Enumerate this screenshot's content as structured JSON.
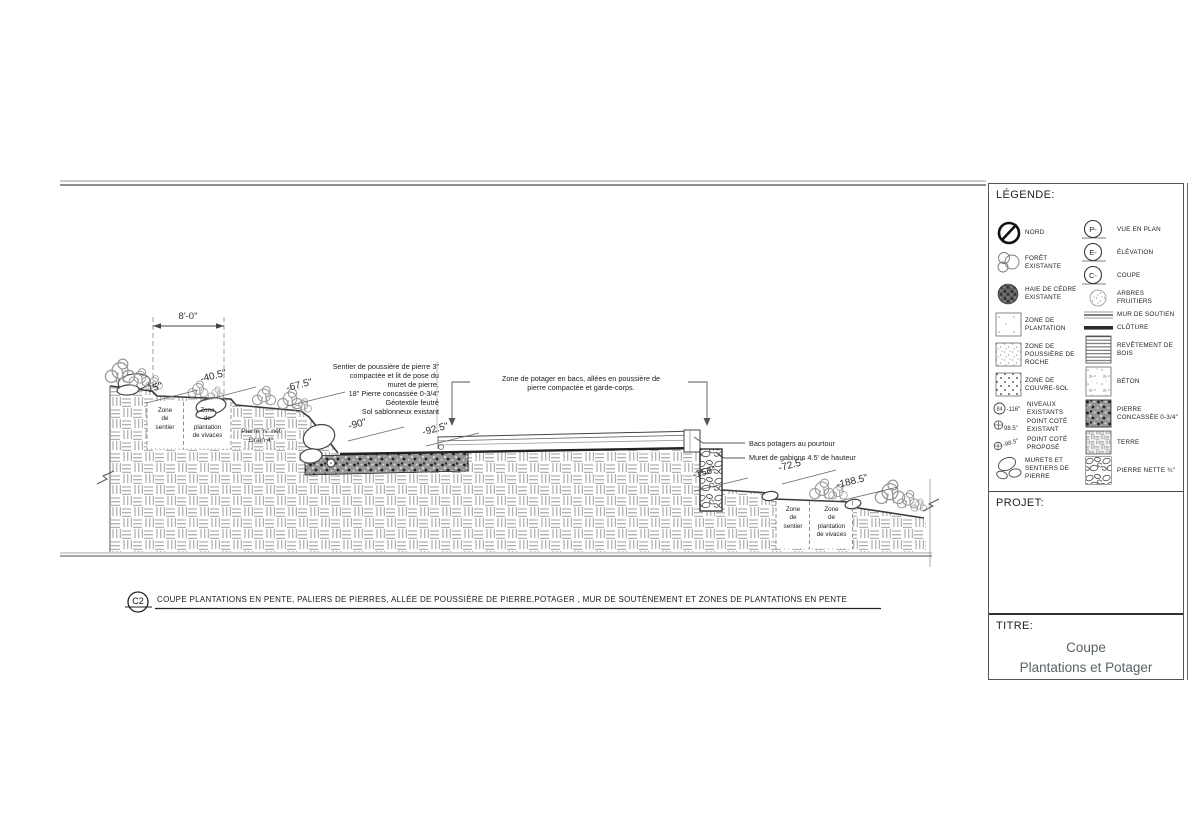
{
  "legend": {
    "title": "LÉGENDE:",
    "col1": [
      {
        "icon": "north-icon",
        "label": "NORD"
      },
      {
        "icon": "existing-forest-icon",
        "label": "FORÊT EXISTANTE"
      },
      {
        "icon": "cedar-hedge-icon",
        "label": "HAIE DE CÈDRE EXISTANTE"
      },
      {
        "icon": "planting-zone-swatch",
        "label": "ZONE DE PLANTATION"
      },
      {
        "icon": "rock-dust-zone-swatch",
        "label": "ZONE DE POUSSIÈRE DE ROCHE"
      },
      {
        "icon": "groundcover-zone-swatch",
        "label": "ZONE DE COUVRE-SOL"
      },
      {
        "icon": "existing-levels-icon",
        "symbol": "84",
        "value": "-116\"",
        "label": "NIVEAUX EXISTANTS"
      },
      {
        "icon": "existing-spot-elevation-icon",
        "value": "98.5\"",
        "label": "POINT COTÉ EXISTANT"
      },
      {
        "icon": "proposed-spot-elevation-icon",
        "value": "-98.5\"",
        "label": "POINT COTÉ PROPOSÉ"
      },
      {
        "icon": "stone-walls-paths-icon",
        "label": "MURETS ET SENTIERS DE PIERRE"
      }
    ],
    "col2": [
      {
        "icon": "plan-view-icon",
        "symbol": "P-",
        "label": "VUE EN PLAN"
      },
      {
        "icon": "elevation-view-icon",
        "symbol": "E-",
        "label": "ÉLÉVATION"
      },
      {
        "icon": "section-view-icon",
        "symbol": "C-",
        "label": "COUPE"
      },
      {
        "icon": "fruit-trees-icon",
        "label": "ARBRES FRUITIERS"
      },
      {
        "icon": "retaining-wall-icon",
        "label": "MUR DE SOUTIEN"
      },
      {
        "icon": "fence-icon",
        "label": "CLÔTURE"
      },
      {
        "icon": "wood-cladding-swatch",
        "label": "REVÊTEMENT DE BOIS"
      },
      {
        "icon": "concrete-swatch",
        "label": "BÉTON"
      },
      {
        "icon": "crushed-stone-swatch",
        "label": "PIERRE CONCASSÉE 0-3/4\""
      },
      {
        "icon": "soil-swatch",
        "label": "TERRE"
      },
      {
        "icon": "clean-stone-swatch",
        "label": "PIERRE NETTE ¾\""
      }
    ]
  },
  "titleblock": {
    "project_label": "PROJET:",
    "title_label": "TITRE:",
    "title": "Coupe\nPlantations et Potager\n&"
  },
  "drawing": {
    "section_tag": "C2",
    "caption": "COUPE PLANTATIONS EN PENTE, PALIERS DE PIERRES, ALLÉE DE POUSSIÈRE DE PIERRE,POTAGER , MUR DE SOUTÈNEMENT ET ZONES DE PLANTATIONS EN PENTE",
    "dimension": "8'-0\"",
    "spots": [
      "-15\"",
      "-40.5\"",
      "-67.5\"",
      "-90\"",
      "-92.5\"",
      "-156\"",
      "-72.5\"",
      "-188.5\""
    ],
    "zones": {
      "left_path": "Zone\nde\nsentier",
      "left_planting": "Zone\nde\nplantation\nde vivaces",
      "right_path": "Zone\nde\nsentier",
      "right_planting": "Zone\nde\nplantation\nde vivaces"
    },
    "wall_note": "Pierre ¾\" net\nDrain 4\"",
    "path_note": "Sentier de poussière de pierre 3\"\ncompactée et lit de pose du\nmuret de pierre.\n18\" Pierre concassée 0-3/4\"\nGéotextile feutré\nSol sablonneux existant",
    "potager_note": "Zone de potager en bacs, allées en poussière de\npierre compactée et garde-corps.",
    "bacs_note": "Bacs potagers au pourtour",
    "gabion_note": "Muret de gabions 4.5' de hauteur"
  }
}
